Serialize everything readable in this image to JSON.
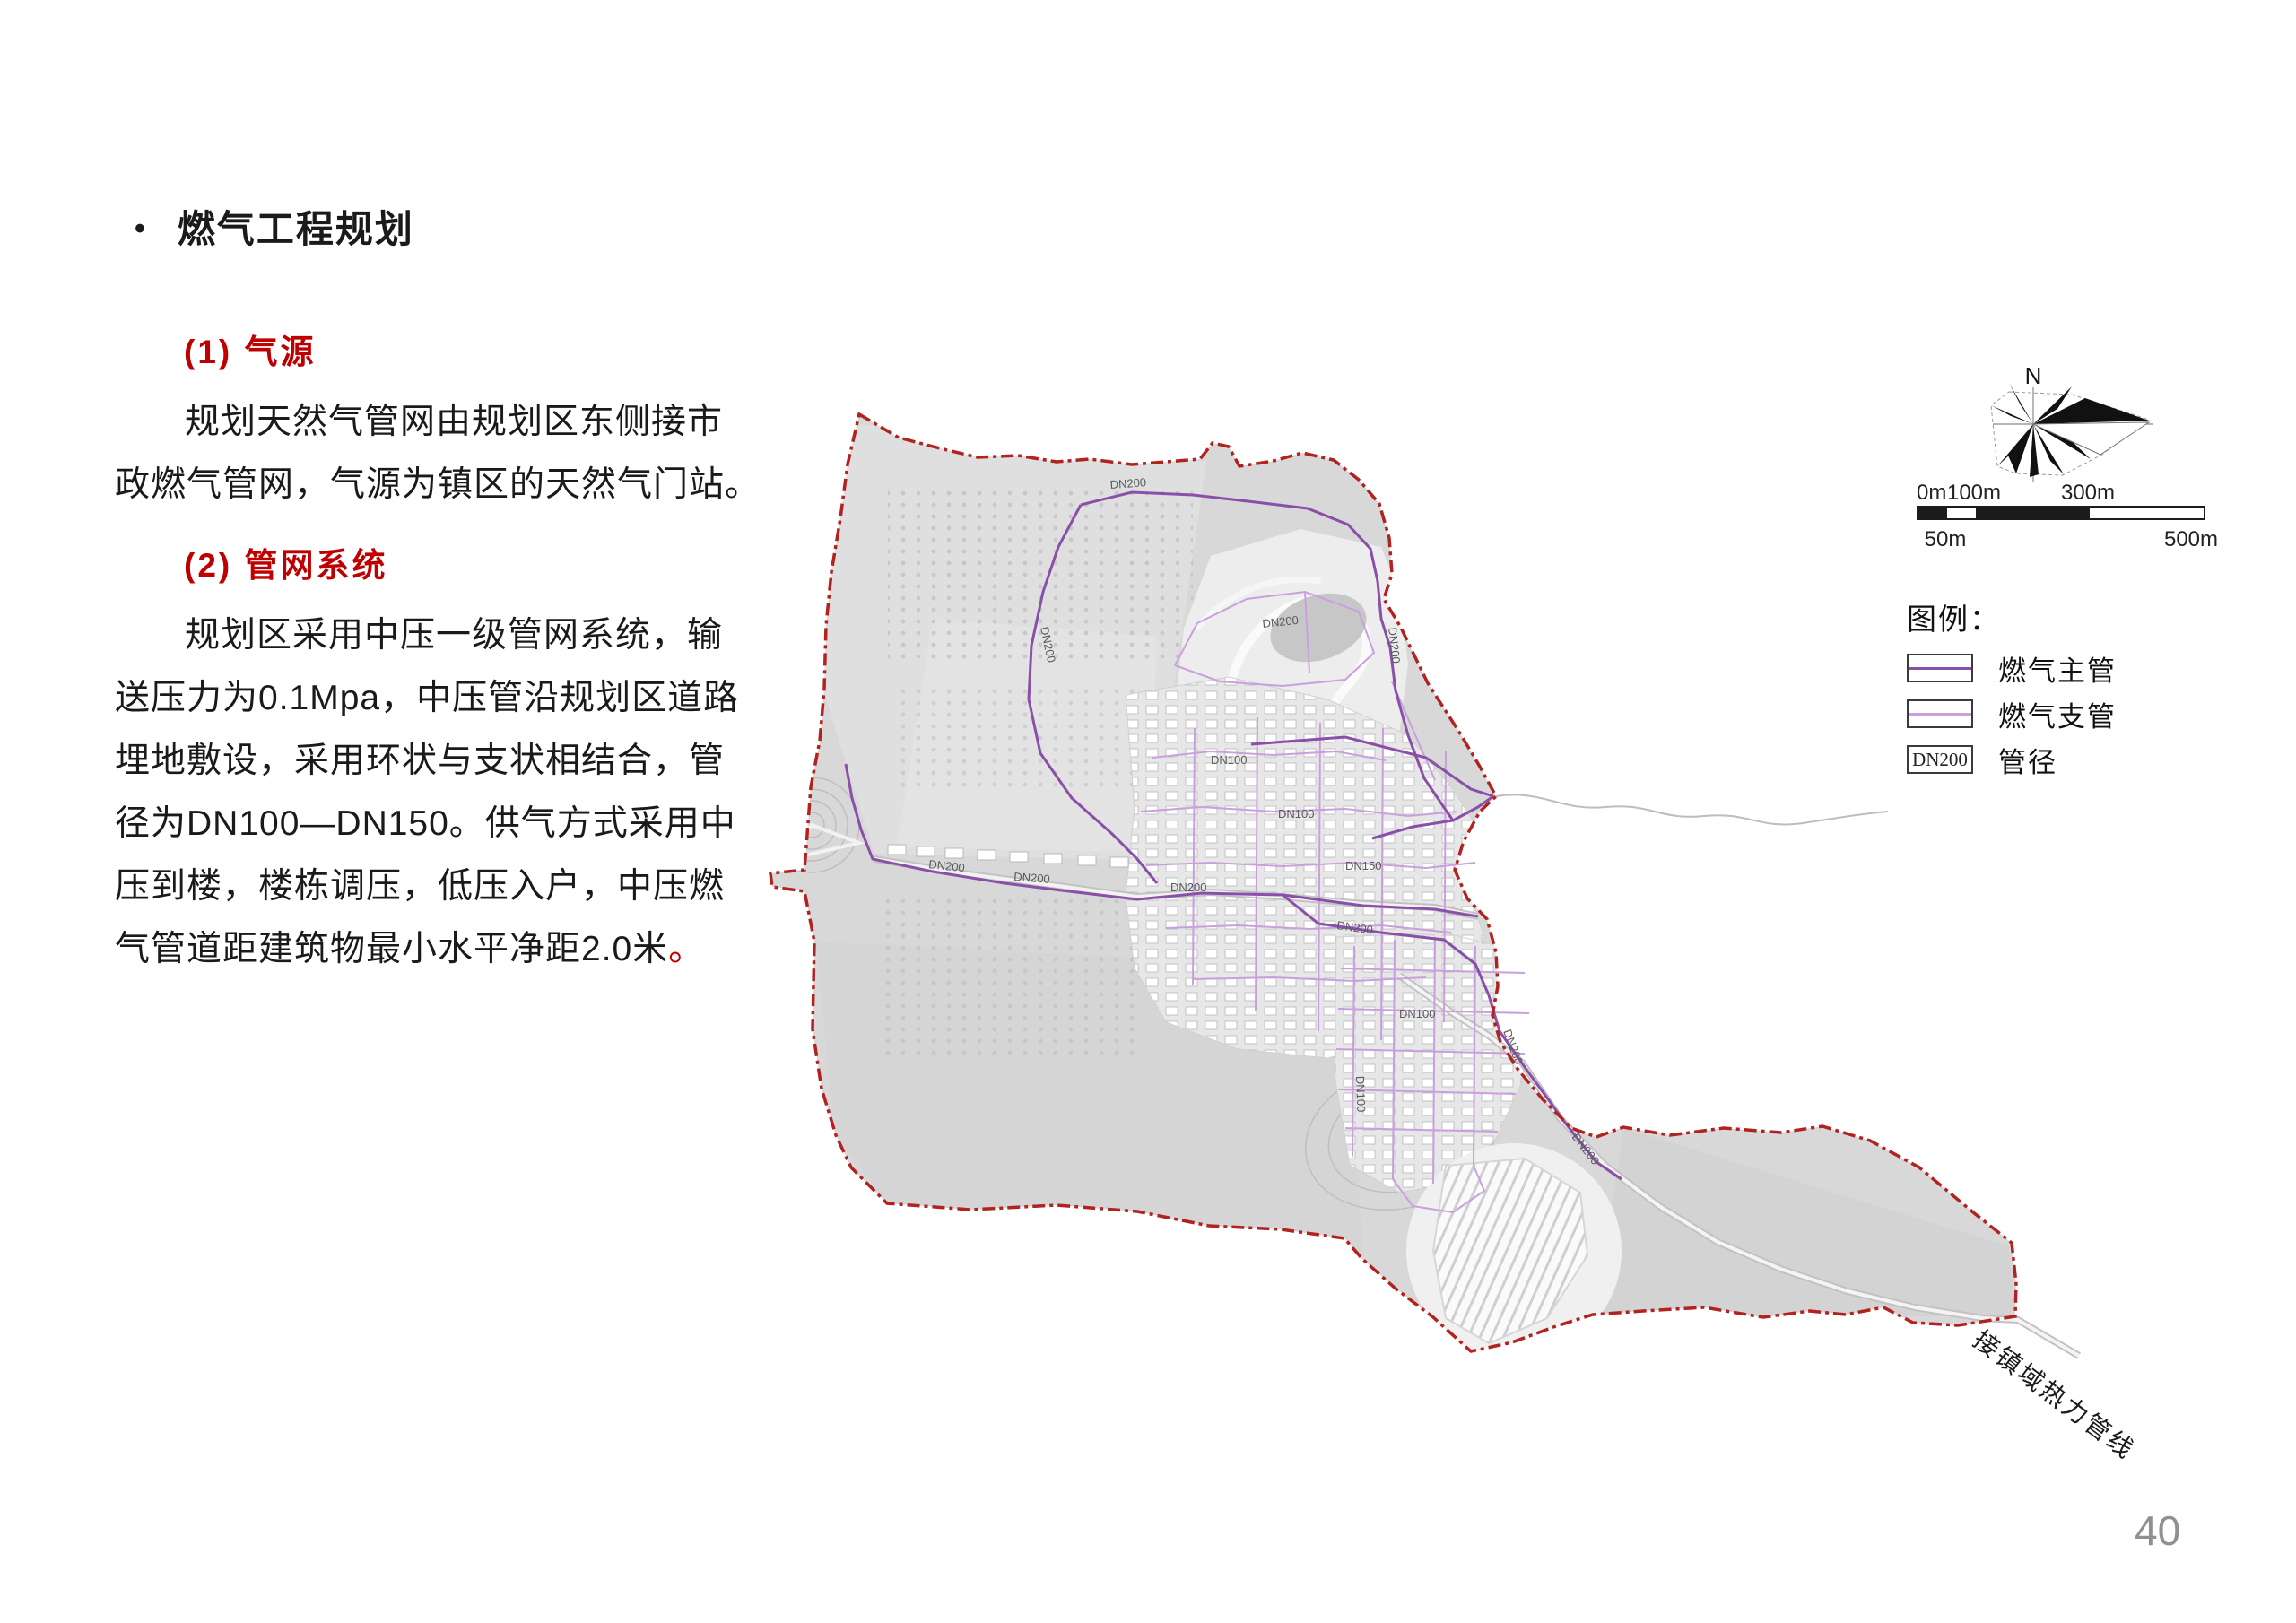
{
  "page": {
    "number": "40"
  },
  "article": {
    "title": {
      "bullet": "•",
      "text": "燃气工程规划"
    },
    "section1": {
      "heading": "(1) 气源",
      "lines": [
        "规划天然气管网由规划区东侧接市",
        "政燃气管网，气源为镇区的天然气门站。"
      ]
    },
    "section2": {
      "heading": "(2) 管网系统",
      "lines": [
        "规划区采用中压一级管网系统，输",
        "送压力为0.1Mpa，中压管沿规划区道路",
        "埋地敷设，采用环状与支状相结合，管",
        "径为DN100—DN150。供气方式采用中",
        "压到楼，楼栋调压，低压入户，中压燃",
        "气管道距建筑物最小水平净距2.0米"
      ],
      "period": "。"
    }
  },
  "map": {
    "north_label": "N",
    "scale_bar": {
      "top_labels": [
        "0m",
        "100m",
        "300m"
      ],
      "bottom_labels": [
        "50m",
        "500m"
      ]
    },
    "legend": {
      "title": "图例：",
      "items": [
        {
          "label": "燃气主管"
        },
        {
          "label": "燃气支管"
        },
        {
          "label": "管径",
          "box_text": "DN200"
        }
      ]
    },
    "annotation": "接镇域热力管线",
    "pipe_labels": {
      "dn200": "DN200",
      "dn100": "DN100",
      "dn150": "DN150"
    },
    "colors": {
      "boundary": "#b2221f",
      "main_pipe": "#8a4fa8",
      "branch_pipe": "#c9a0dc",
      "heading_red": "#C00000",
      "page_number": "#909090"
    }
  }
}
